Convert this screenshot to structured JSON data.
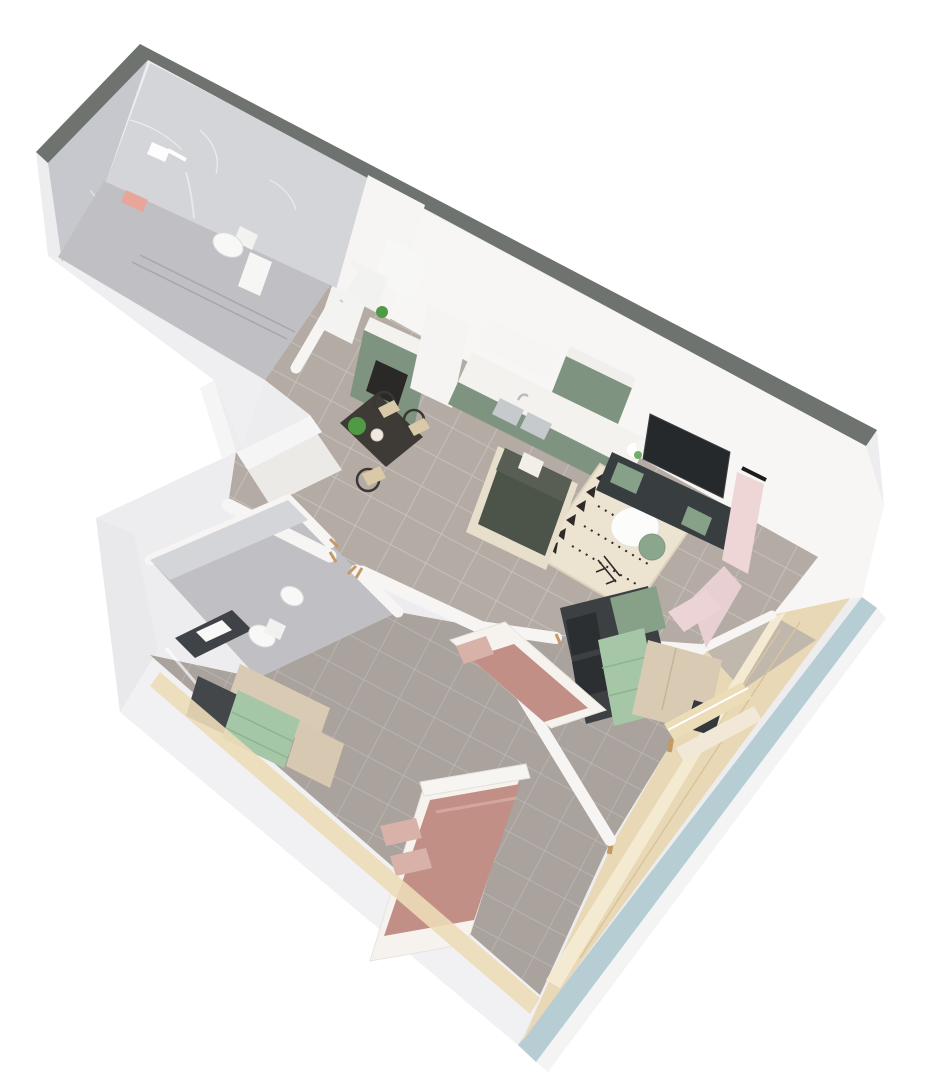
{
  "meta": {
    "description": "3D rendered top-down isometric floor plan of an apartment",
    "style": "soft pastel architectural visualization on white background",
    "projection": "rotated top view, approx 28 degrees",
    "background": "#ffffff"
  },
  "palette": {
    "band": "#6e736f",
    "facade_blue": "#b7cdd4",
    "wall": "#f7f6f4",
    "wall_shade": "#efeff1",
    "outer_face": "#ededef",
    "marble_wall": "#d4d5d9",
    "marble_wall_dark": "#c6c8cd",
    "marble_floor": "#c0bfc4",
    "tile_floor": "#b4aca4",
    "tile_floor2": "#a9a29d",
    "wood_balcony": "#e9d8b6",
    "window_cream": "#ecdcb8",
    "cabinet_sage": "#7e9480",
    "counter_white": "#f3f2ee",
    "appliance_dark": "#2b2927",
    "table_dark": "#3e3a36",
    "chair_dark": "#3a3734",
    "seat_tan": "#d9c9a8",
    "sofa_green": "#4c5349",
    "sofa_frame": "#e7dfcc",
    "rug_base": "#ece3d0",
    "rug_pattern": "#2d2a27",
    "coffee_white": "#fcfcfb",
    "side_green": "#8aa68c",
    "tv_dark": "#26292c",
    "tv_stand": "#383d40",
    "curtain_pink": "#eed5d6",
    "bed_mauve": "#c28f87",
    "bed_white": "#f6f3ee",
    "pillow_blush": "#d8b1a8",
    "wardrobe_wood": "#d8cab3",
    "wardrobe_mint": "#a5c7a7",
    "shelf_dark": "#3c4043",
    "shelf_sage": "#87a189",
    "fixture_white": "#f8f8f7",
    "plant_green": "#4f9b45",
    "towel_pink": "#e8a59a",
    "door_tan": "#c39a66"
  },
  "rooms": [
    {
      "id": "bathroom-1",
      "label": "Bathroom 1 — walk-in shower, handheld shower, wall-hung toilet, pink towel, marble walls"
    },
    {
      "id": "entry-hall",
      "label": "Hallway and entry nook with built-in closet"
    },
    {
      "id": "kitchen-dining",
      "label": "Kitchen and dining — fridge, oven cabinet, sage cabinets, double sink, dining table with bentwood chairs"
    },
    {
      "id": "living-room",
      "label": "Living room — dark green sofa, boho rug, round coffee table, green side table, wall TV, TV stand, pink curtains"
    },
    {
      "id": "bathroom-2",
      "label": "Bathroom 2 — vanity with basin, wall-hung toilet, bidet, glass shower screen"
    },
    {
      "id": "master-bedroom",
      "label": "Master bedroom — double bed with mauve blanket, wardrobe with mint drawers, window"
    },
    {
      "id": "kids-bedroom",
      "label": "Second bedroom — single bed, shelving unit with mint drawers, wardrobe, window"
    },
    {
      "id": "balcony",
      "label": "Balcony loggia — wood flooring, cream window ledge, light blue facade"
    }
  ]
}
